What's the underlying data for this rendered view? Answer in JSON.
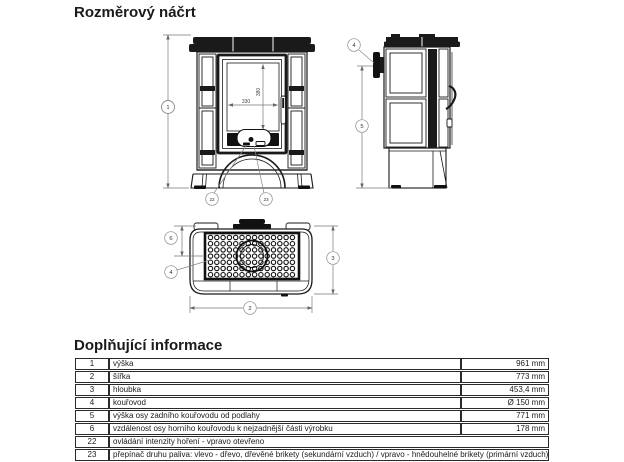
{
  "page": {
    "title": "Rozměrový náčrt",
    "info_title": "Doplňující informace"
  },
  "drawing": {
    "front": {
      "callout_height": "1",
      "callout_intensity": "22",
      "callout_fuel": "23",
      "glass_width": "330",
      "glass_height": "380"
    },
    "side": {
      "callout_flue": "4",
      "callout_flue_axis": "5"
    },
    "top": {
      "callout_rear_dist": "6",
      "callout_flue": "4",
      "callout_depth": "3",
      "callout_width": "2"
    }
  },
  "table": {
    "rows": [
      {
        "num": "1",
        "desc": "výška",
        "value": "961 mm"
      },
      {
        "num": "2",
        "desc": "šířka",
        "value": "773 mm"
      },
      {
        "num": "3",
        "desc": "hloubka",
        "value": "453,4 mm"
      },
      {
        "num": "4",
        "desc": "kouřovod",
        "value": "Ø 150 mm"
      },
      {
        "num": "5",
        "desc": "výška osy zadního kouřovodu od podlahy",
        "value": "771 mm"
      },
      {
        "num": "6",
        "desc": "vzdálenost osy horního kouřovodu k nejzadnější části výrobku",
        "value": "178 mm"
      },
      {
        "num": "22",
        "desc": "ovládání intenzity hoření - vpravo otevřeno",
        "value": ""
      },
      {
        "num": "23",
        "desc": "přepínač druhu paliva: vlevo - dřevo, dřevěné brikety (sekundární vzduch) / vpravo - hnědouhelné brikety (primární vzduch)",
        "value": ""
      }
    ]
  }
}
